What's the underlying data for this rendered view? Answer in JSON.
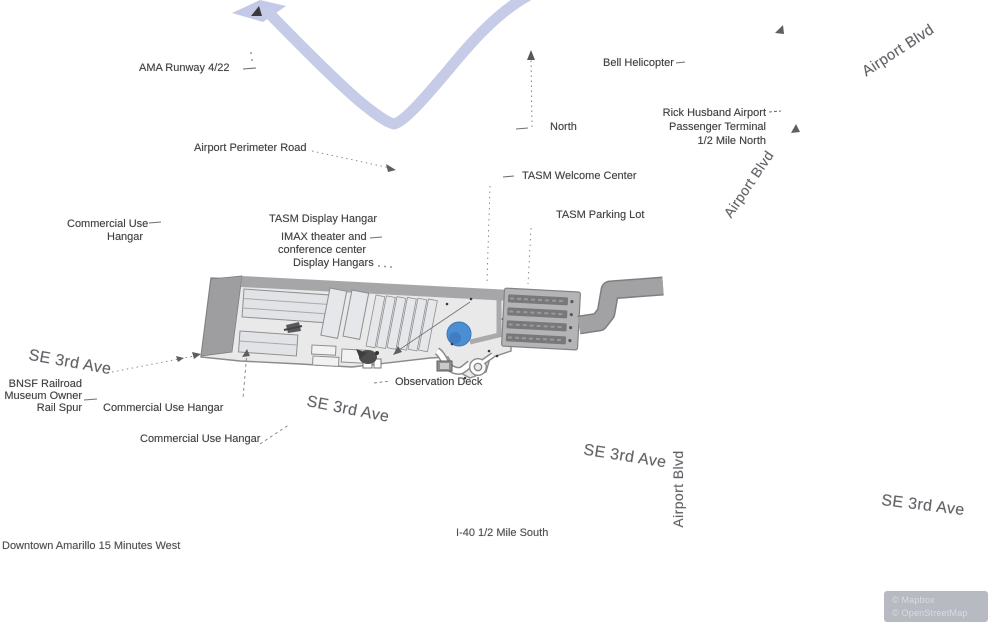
{
  "labels": {
    "ama_runway": "AMA Runway 4/22",
    "bell_helicopter": "Bell Helicopter",
    "north": "North",
    "rick_husband_line1": "Rick Husband Airport",
    "rick_husband_line2": "Passenger Terminal",
    "rick_husband_line3": "1/2 Mile North",
    "airport_perimeter_road": "Airport Perimeter Road",
    "tasm_welcome_center": "TASM Welcome Center",
    "tasm_display_hangar": "TASM Display Hangar",
    "tasm_parking_lot": "TASM Parking Lot",
    "commercial_use_hangar_nw_line1": "Commercial Use",
    "commercial_use_hangar_nw_line2": "Hangar",
    "imax_line1": "IMAX theater and",
    "imax_line2": "conference center",
    "display_hangars": "Display Hangars",
    "bnsf_line1": "BNSF Railroad",
    "bnsf_line2": "Museum Owner",
    "bnsf_line3": "Rail Spur",
    "commercial_use_hangar_sw": "Commercial Use Hangar",
    "commercial_use_hangar_s": "Commercial Use Hangar",
    "observation_deck": "Observation Deck",
    "i40": "I-40 1/2 Mile South",
    "downtown": "Downtown Amarillo 15 Minutes West"
  },
  "streets": {
    "se_3rd_ave": "SE 3rd Ave",
    "airport_blvd": "Airport Blvd"
  },
  "attribution": {
    "line1": "© Mapbox",
    "line2": "© OpenStreetMap"
  },
  "colors": {
    "runway_band": "#c6cbe8",
    "site_fill": "#e9e9e9",
    "site_stroke": "#8a8a8a",
    "dark_block": "#9e9ea0",
    "hangar_fill": "#e2e3e7",
    "parking_fill": "#b4b4b6",
    "parking_rows": "#78787a",
    "access_road": "#a2a2a4",
    "pond_blue": "#4b8fd2",
    "annotation_text": "#3d3e40",
    "street_text": "#606266",
    "attribution_bg": "#b7bac1"
  }
}
